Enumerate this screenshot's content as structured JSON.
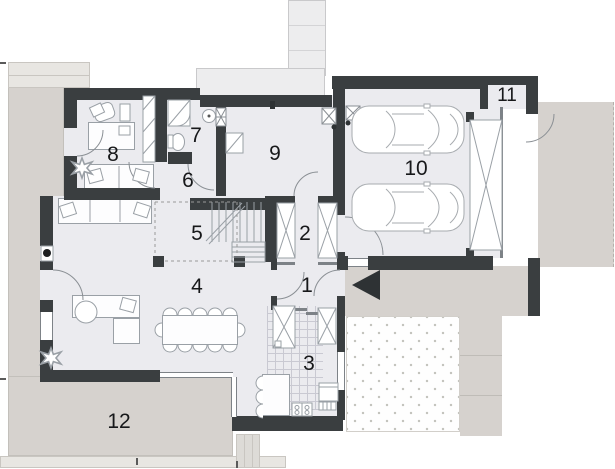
{
  "plan": {
    "title": "ground-floor architectural plan",
    "rooms": [
      {
        "number": "1"
      },
      {
        "number": "2"
      },
      {
        "number": "3"
      },
      {
        "number": "4"
      },
      {
        "number": "5"
      },
      {
        "number": "6"
      },
      {
        "number": "7"
      },
      {
        "number": "8"
      },
      {
        "number": "9"
      },
      {
        "number": "10"
      },
      {
        "number": "11"
      },
      {
        "number": "12"
      }
    ],
    "colors": {
      "wall": "#3a3e40",
      "room_floor": "#ebebef",
      "terrace": "#d6d2ce",
      "steps": "#e8e6e2",
      "roof_band": "#ededee",
      "furniture_line": "#9aa0a6",
      "entrance_marker": "#2e3234"
    },
    "markers": {
      "entrance_arrow": "black triangle pointing left at main entry door"
    }
  }
}
